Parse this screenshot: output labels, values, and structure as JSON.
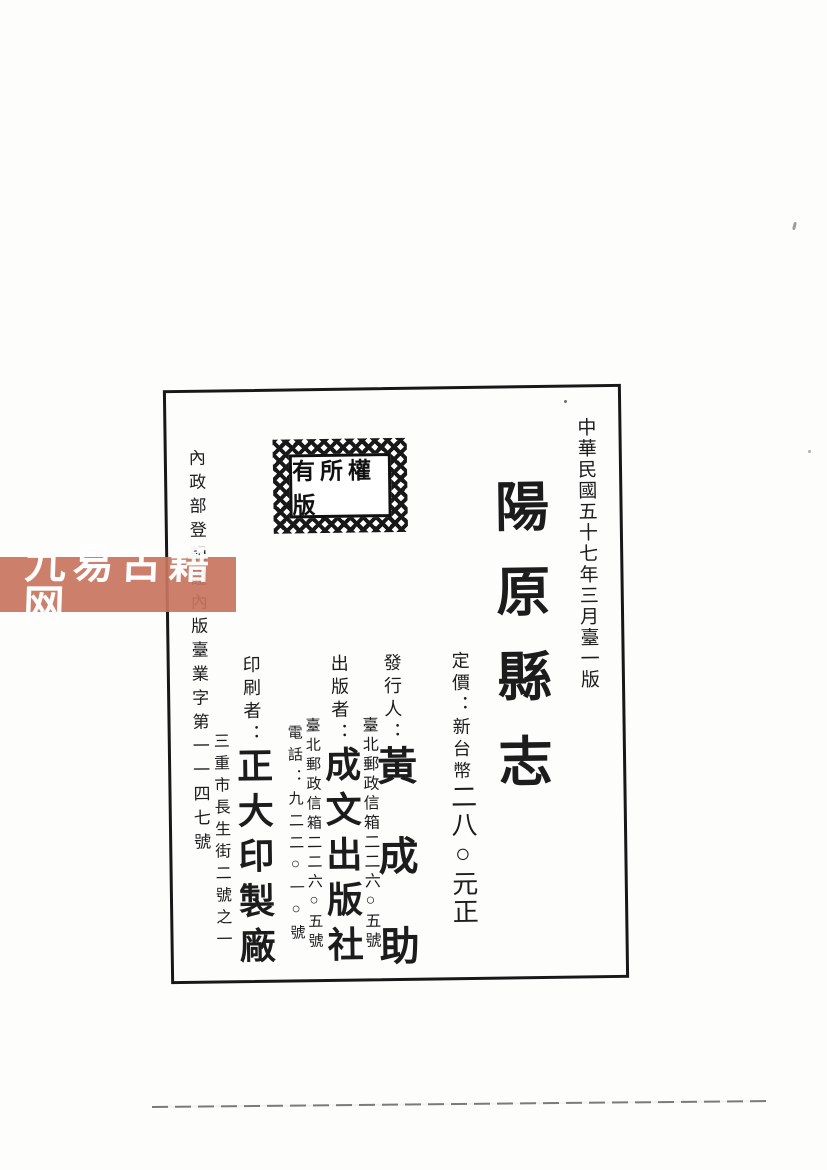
{
  "watermark": {
    "text": "九易古籍网",
    "band_color": "#c8765f",
    "text_color": "#ffffff"
  },
  "colophon": {
    "edition_date": "中華民國五十七年三月臺一版",
    "title": "陽原縣志",
    "stamp_text": "有所權版",
    "registration": "內政部登記證內版臺業字第一一四七號",
    "price": {
      "label": "定價：",
      "currency": "新台幣",
      "amount": "二八○元正"
    },
    "issuer": {
      "label": "發行人：",
      "name": "黃成助",
      "address": "臺北郵政信箱二二六○五號"
    },
    "publisher": {
      "label": "出版者：",
      "name": "成文出版社",
      "address": "臺北郵政信箱二二六○五號",
      "phone": "電話：九二二○一○號"
    },
    "printer": {
      "label": "印刷者：",
      "name": "正大印製廠",
      "address": "三重市長生街二號之一"
    }
  }
}
